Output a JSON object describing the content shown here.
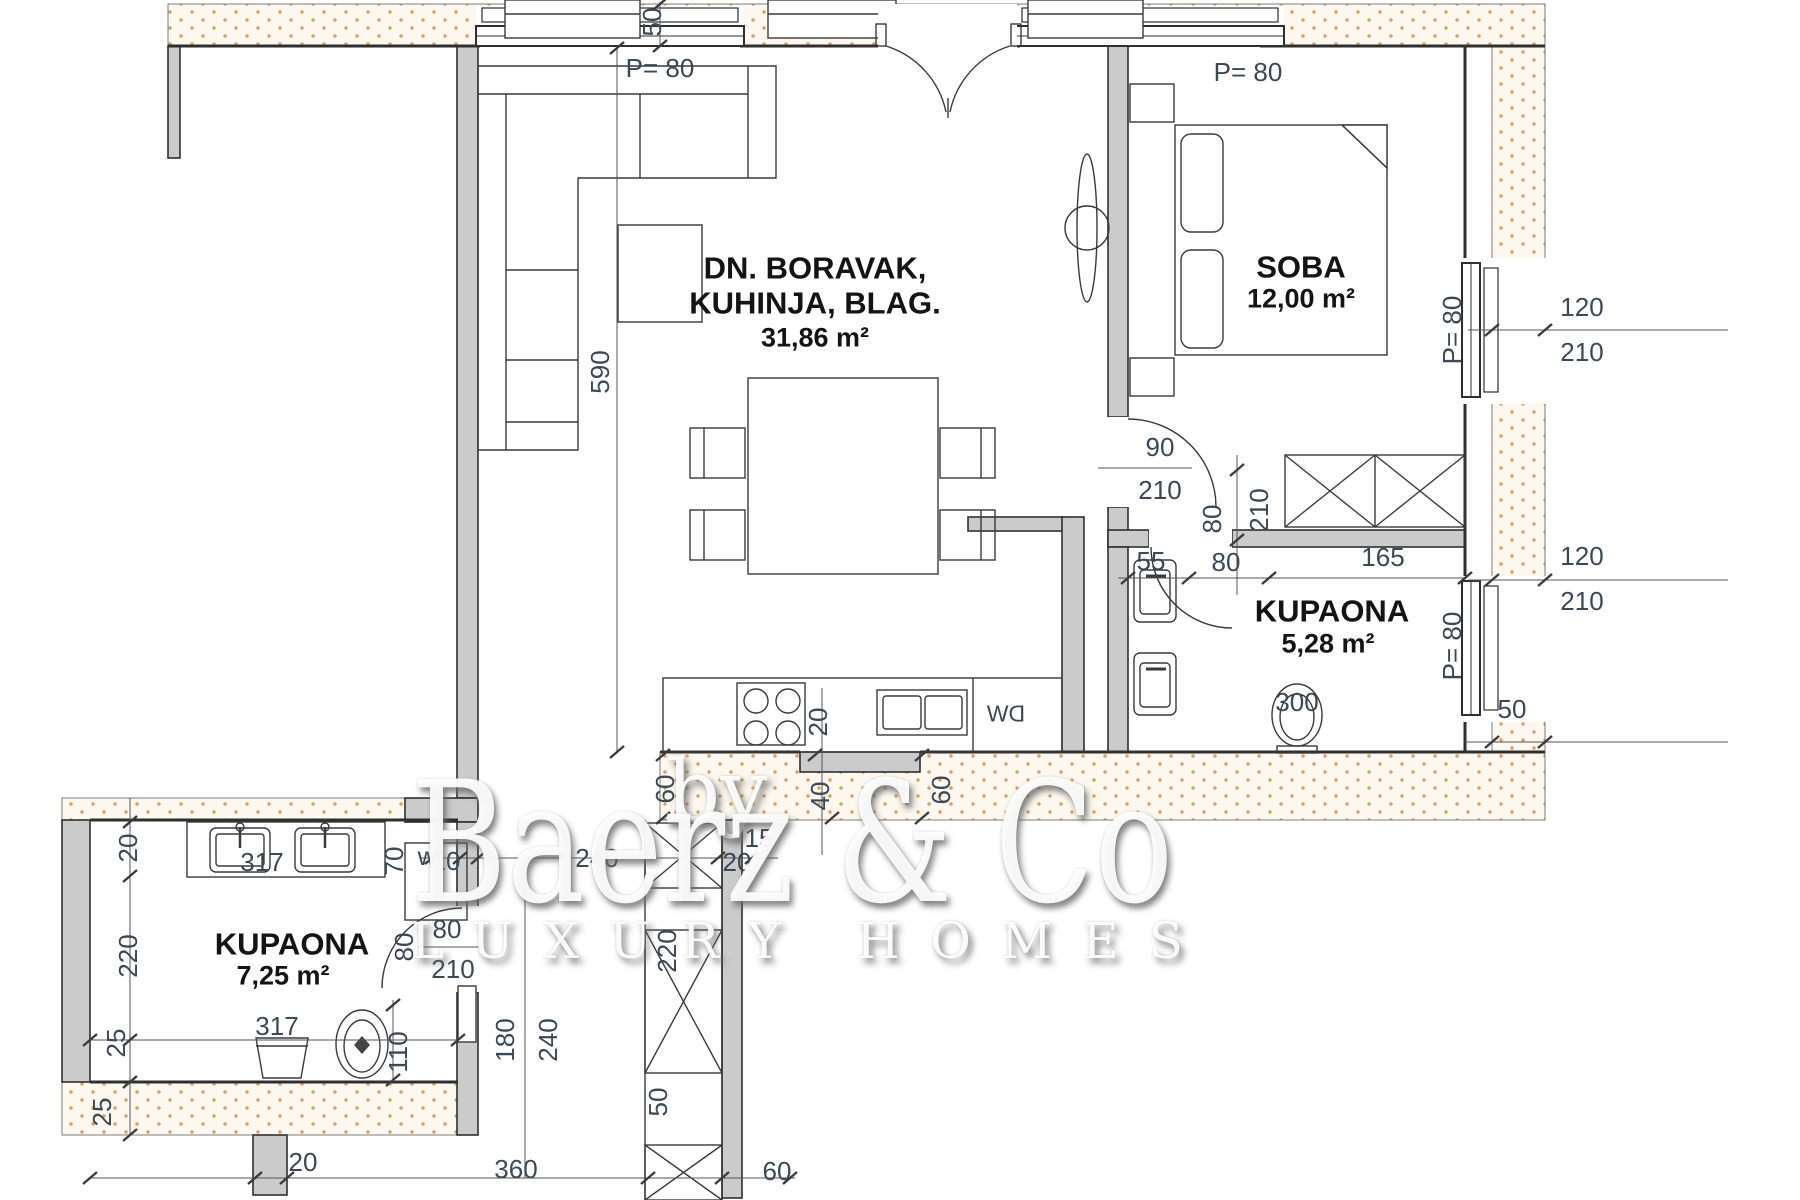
{
  "rooms": {
    "living": {
      "line1": "DN. BORAVAK,",
      "line2": "KUHINJA, BLAG.",
      "area": "31,86 m²"
    },
    "bedroom": {
      "name": "SOBA",
      "area": "12,00 m²"
    },
    "bathroom_main": {
      "name": "KUPAONA",
      "area": "5,28 m²"
    },
    "bathroom_lower": {
      "name": "KUPAONA",
      "area": "7,25 m²"
    }
  },
  "labels": {
    "p80": "P= 80",
    "n10": "10",
    "n15": "15",
    "n20": "20",
    "n25": "25",
    "n40": "40",
    "n50": "50",
    "n55": "55",
    "n60": "60",
    "n70": "70",
    "n80": "80",
    "n90": "90",
    "n110": "110",
    "n120": "120",
    "n165": "165",
    "n180": "180",
    "n210": "210",
    "n220": "220",
    "n240": "240",
    "n300": "300",
    "n317": "317",
    "n360": "360",
    "n590": "590",
    "washer": "w",
    "dishwasher": "DW"
  },
  "watermark": {
    "by": "by",
    "brand": "Baerz & Co",
    "tagline": "LUXURY HOMES"
  }
}
